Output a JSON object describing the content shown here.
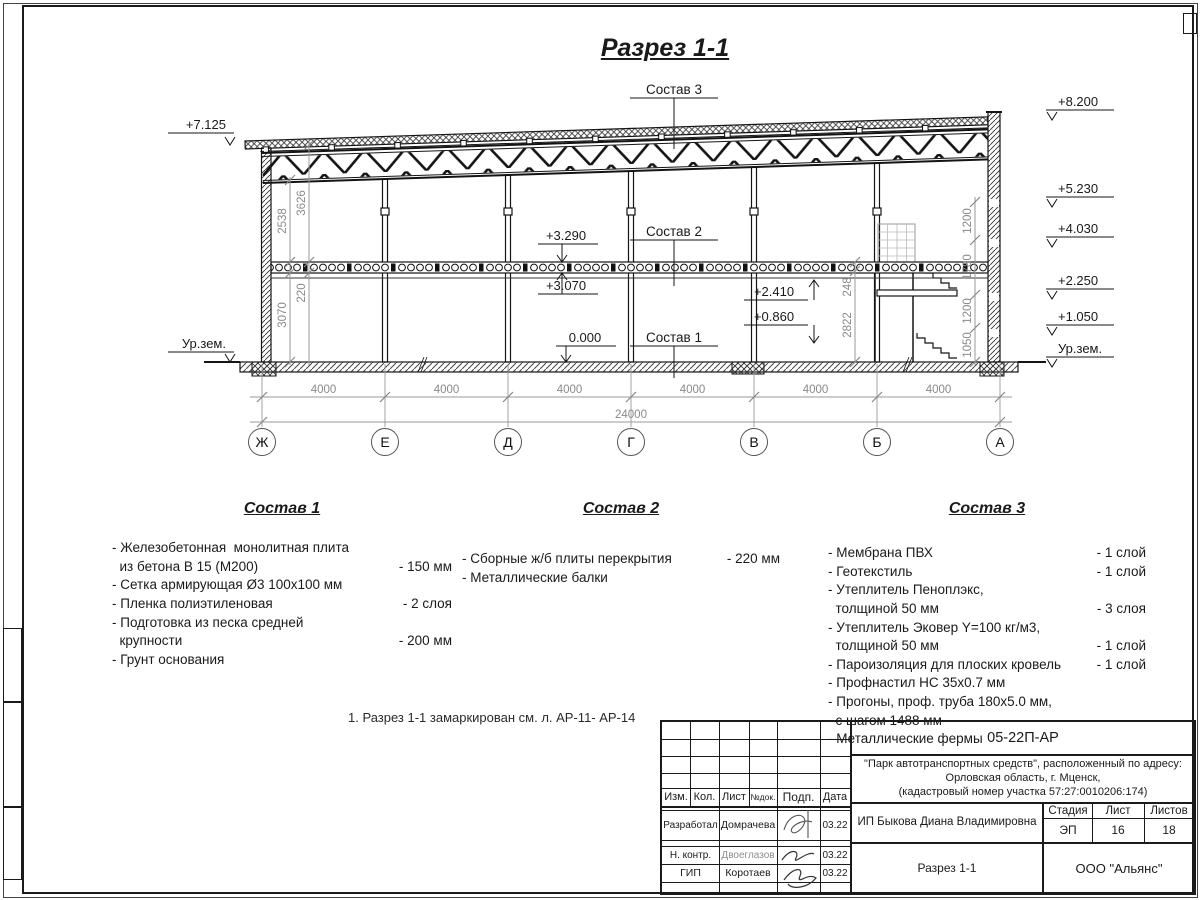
{
  "sheet": {
    "title": "Разрез 1-1",
    "note": "1. Разрез 1-1 замаркирован см. л. АР-11- АР-14"
  },
  "section": {
    "mark_left_top": "+7.125",
    "mark_left_ground": "Ур.зем.",
    "marks_right": [
      "+8.200",
      "+5.230",
      "+4.030",
      "+2.250",
      "+1.050",
      "Ур.зем."
    ],
    "mark_slab_top": "+3.290",
    "mark_slab_bottom": "+3.070",
    "mark_zero": "0.000",
    "mark_up": "+2.410",
    "mark_down": "+0.860",
    "label_c1": "Состав 1",
    "label_c2": "Состав 2",
    "label_c3": "Состав 3",
    "dim_2538": "2538",
    "dim_3626": "3626",
    "dim_220": "220",
    "dim_3070": "3070",
    "dims_wall": [
      "1200",
      "1780",
      "1200",
      "1050"
    ],
    "dim_248": "248",
    "dim_2822": "2822",
    "bays": [
      "4000",
      "4000",
      "4000",
      "4000",
      "4000",
      "4000"
    ],
    "total": "24000",
    "axes": [
      "Ж",
      "Е",
      "Д",
      "Г",
      "В",
      "Б",
      "А"
    ]
  },
  "legend": {
    "sections": [
      {
        "title": "Состав 1",
        "items": [
          {
            "text": "- Железобетонная  монолитная плита\n  из бетона В 15 (М200)",
            "value": "- 150 мм"
          },
          {
            "text": "- Сетка армирующая Ø3 100х100 мм",
            "value": ""
          },
          {
            "text": "- Пленка полиэтиленовая",
            "value": "-  2 слоя"
          },
          {
            "text": "- Подготовка из песка средней\n  крупности",
            "value": "- 200 мм"
          },
          {
            "text": "- Грунт основания",
            "value": ""
          }
        ]
      },
      {
        "title": "Состав 2",
        "items": [
          {
            "text": "- Сборные ж/б плиты перекрытия",
            "value": "- 220 мм"
          },
          {
            "text": "- Металлические балки",
            "value": ""
          }
        ]
      },
      {
        "title": "Состав 3",
        "items": [
          {
            "text": "- Мембрана ПВХ",
            "value": "- 1 слой"
          },
          {
            "text": "- Геотекстиль",
            "value": "- 1 слой"
          },
          {
            "text": "- Утеплитель Пеноплэкс,\n  толщиной 50 мм",
            "value": "- 3 слоя"
          },
          {
            "text": "- Утеплитель Эковер Y=100 кг/м3,\n  толщиной 50 мм",
            "value": "- 1 слой"
          },
          {
            "text": "- Пароизоляция для плоских кровель",
            "value": "- 1 слой"
          },
          {
            "text": "- Профнастил НС 35х0.7 мм",
            "value": ""
          },
          {
            "text": "- Прогоны, проф. труба 180х5.0 мм,\n  с шагом 1488 мм",
            "value": ""
          },
          {
            "text": "- Металлические фермы",
            "value": ""
          }
        ]
      }
    ]
  },
  "titleblock": {
    "doc_number": "05-22П-АР",
    "project": "\"Парк автотранспортных средств\",  расположенный по адресу:\nОрловская область, г. Мценск,\n(кадастровый номер участка 57:27:0010206:174)",
    "header": [
      "Изм.",
      "Кол.",
      "Лист",
      "№док.",
      "Подп.",
      "Дата"
    ],
    "signers": [
      {
        "role": "Разработал",
        "name": "Домрачева",
        "date": "03.22"
      },
      {
        "role": "Н. контр.",
        "name": "Двоеглазов",
        "date": "03.22"
      },
      {
        "role": "ГИП",
        "name": "Коротаев",
        "date": "03.22"
      }
    ],
    "client": "ИП Быкова Диана Владимировна",
    "stage_label": "Стадия",
    "sheet_label": "Лист",
    "sheets_label": "Листов",
    "stage": "ЭП",
    "sheet": "16",
    "sheets": "18",
    "drawing_title": "Разрез 1-1",
    "company": "ООО \"Альянс\""
  }
}
